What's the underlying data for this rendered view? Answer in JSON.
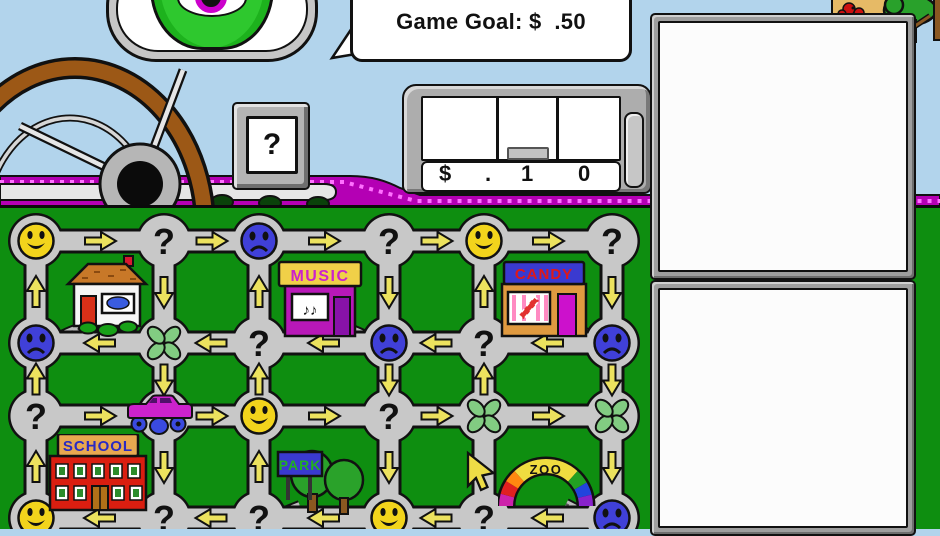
{
  "hud": {
    "game_goal": "Game Goal: $  .50",
    "help_button": "?",
    "register": {
      "dollar_sign": "$",
      "decimal_point": ".",
      "dimes_digit": "1",
      "pennies_digit": "0"
    }
  },
  "board": {
    "node_types": [
      [
        "smiley",
        "question",
        "sad",
        "question",
        "smiley",
        "question"
      ],
      [
        "sad",
        "clover",
        "question",
        "sad",
        "question",
        "sad"
      ],
      [
        "question",
        "plain",
        "smiley",
        "question",
        "clover",
        "clover"
      ],
      [
        "smiley",
        "question",
        "question",
        "smiley",
        "question",
        "sad"
      ]
    ],
    "h_arrow_dirs": [
      "right",
      "left",
      "right",
      "left"
    ],
    "v_arrow_rows": [
      [
        "up",
        "down",
        "up",
        "down",
        "up",
        "down"
      ],
      [
        "up",
        "down",
        "up",
        "down",
        "up",
        "down"
      ],
      [
        "up",
        "down",
        "up",
        "down",
        null,
        "down"
      ]
    ],
    "buildings": [
      {
        "id": "house",
        "label": ""
      },
      {
        "id": "music",
        "label": "MUSIC",
        "sign_bg": "#f0d048",
        "sign_color": "#cc22cc"
      },
      {
        "id": "candy",
        "label": "CANDY",
        "sign_bg": "#3a3ad0",
        "sign_color": "#e01818"
      },
      {
        "id": "school",
        "label": "SCHOOL",
        "sign_bg": "#e8a850",
        "sign_color": "#2a2ac4"
      },
      {
        "id": "park",
        "label": "PARK",
        "sign_bg": "#3a3ad0",
        "sign_color": "#22b022"
      },
      {
        "id": "zoo",
        "label": "ZOO",
        "sign_bg": "#f0dc40",
        "sign_color": "#111111"
      }
    ],
    "music_window_notes": "♪♪"
  },
  "colors": {
    "sky": "#b2d4ec",
    "grass": "#0e8e10",
    "road": "#c8c8c8",
    "dash": "#b400b4",
    "dash_dots": "#ff70ff",
    "arrow": "#ece25e",
    "smiley": "#f2d41c",
    "sad": "#4040d8",
    "clover": "#82cc82",
    "monster": "#2ec82e",
    "iris": "#cc00cc",
    "car": "#cc22cc",
    "car_wheel": "#3a4ae0",
    "cursor": "#eedc46"
  }
}
